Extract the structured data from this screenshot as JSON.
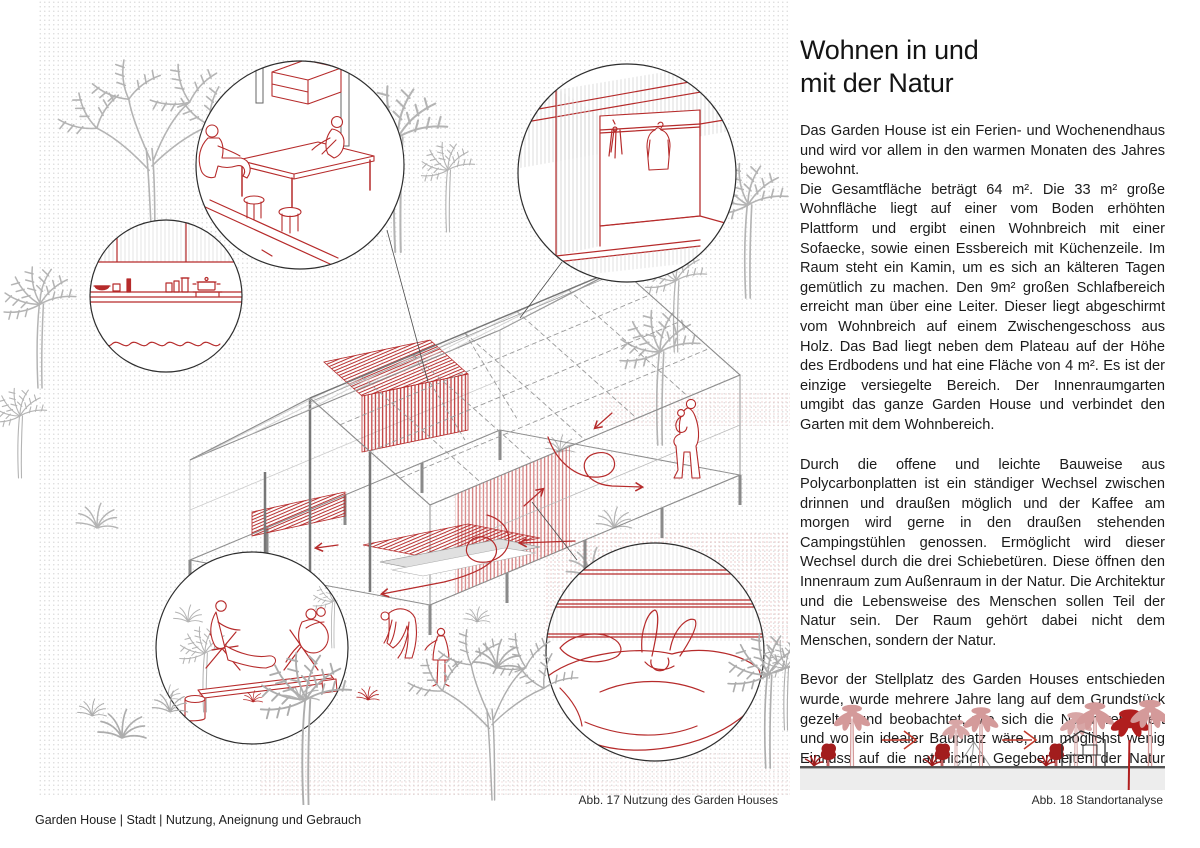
{
  "article": {
    "title": "Wohnen in und\nmit der Natur",
    "paragraphs": [
      "Das Garden House ist ein Ferien- und Wochenendhaus und wird vor allem in den warmen Monaten des Jahres bewohnt.\nDie Gesamtfläche beträgt 64 m². Die 33 m² große Wohnfläche liegt auf einer vom Boden erhöhten Plattform und ergibt einen Wohnbreich mit einer Sofaecke, sowie einen Essbereich mit Küchenzeile. Im Raum steht ein Kamin, um es sich an kälteren Tagen gemütlich zu machen. Den 9m² großen Schlafbereich erreicht man über eine Leiter. Dieser liegt abgeschirmt vom Wohnbreich auf einem Zwischengeschoss aus Holz. Das Bad liegt neben dem Plateau auf der Höhe des Erdbodens und hat eine Fläche von 4 m². Es ist der einzige versiegelte Bereich. Der Innenraumgarten umgibt das ganze Garden House und verbindet den Garten mit dem Wohnbereich.",
      "Durch die offene und leichte Bauweise aus Polycarbonplatten ist ein ständiger Wechsel zwischen drinnen und draußen möglich und der Kaffee am morgen wird gerne in den draußen stehenden Campingstühlen genossen. Ermöglicht wird dieser Wechsel durch die drei Schiebetüren. Diese öffnen den Innenraum zum Außenraum in der Natur. Die Architektur und die Lebensweise des Menschen sollen Teil der Natur sein. Der Raum gehört dabei nicht dem Menschen, sondern der Natur.",
      "Bevor der Stellplatz des Garden Houses entschieden wurde, wurde mehrere Jahre lang auf dem Grundstück gezeltet und beobachtet, wie sich die Natur verändert und wo ein idealer Bauplatz wäre, um möglichst wenig Einfluss auf die natürlichen Gegebenheiten der Natur auszuüben."
    ]
  },
  "figures": {
    "main": {
      "caption": "Abb. 17 Nutzung des Garden Houses",
      "callouts": [
        "dining-area",
        "wardrobe",
        "kitchen-shelf",
        "garden-lounge",
        "sleeping-area"
      ]
    },
    "site": {
      "caption": "Abb. 18 Standortanalyse",
      "stage_icons": [
        "trees-only",
        "trees-with-tent",
        "trees-with-house"
      ]
    }
  },
  "footer": {
    "text": "Garden House | Stadt | Nutzung, Aneignung und Gebrauch"
  },
  "colors": {
    "accent_red": "#b62b2b",
    "dark_red": "#a21d1d",
    "pale_red": "#d49a9a",
    "tree_gray": "#b4b4b4",
    "line_dark": "#3a3a3a",
    "ground_gray": "#ededed",
    "text": "#1b1b1b"
  }
}
